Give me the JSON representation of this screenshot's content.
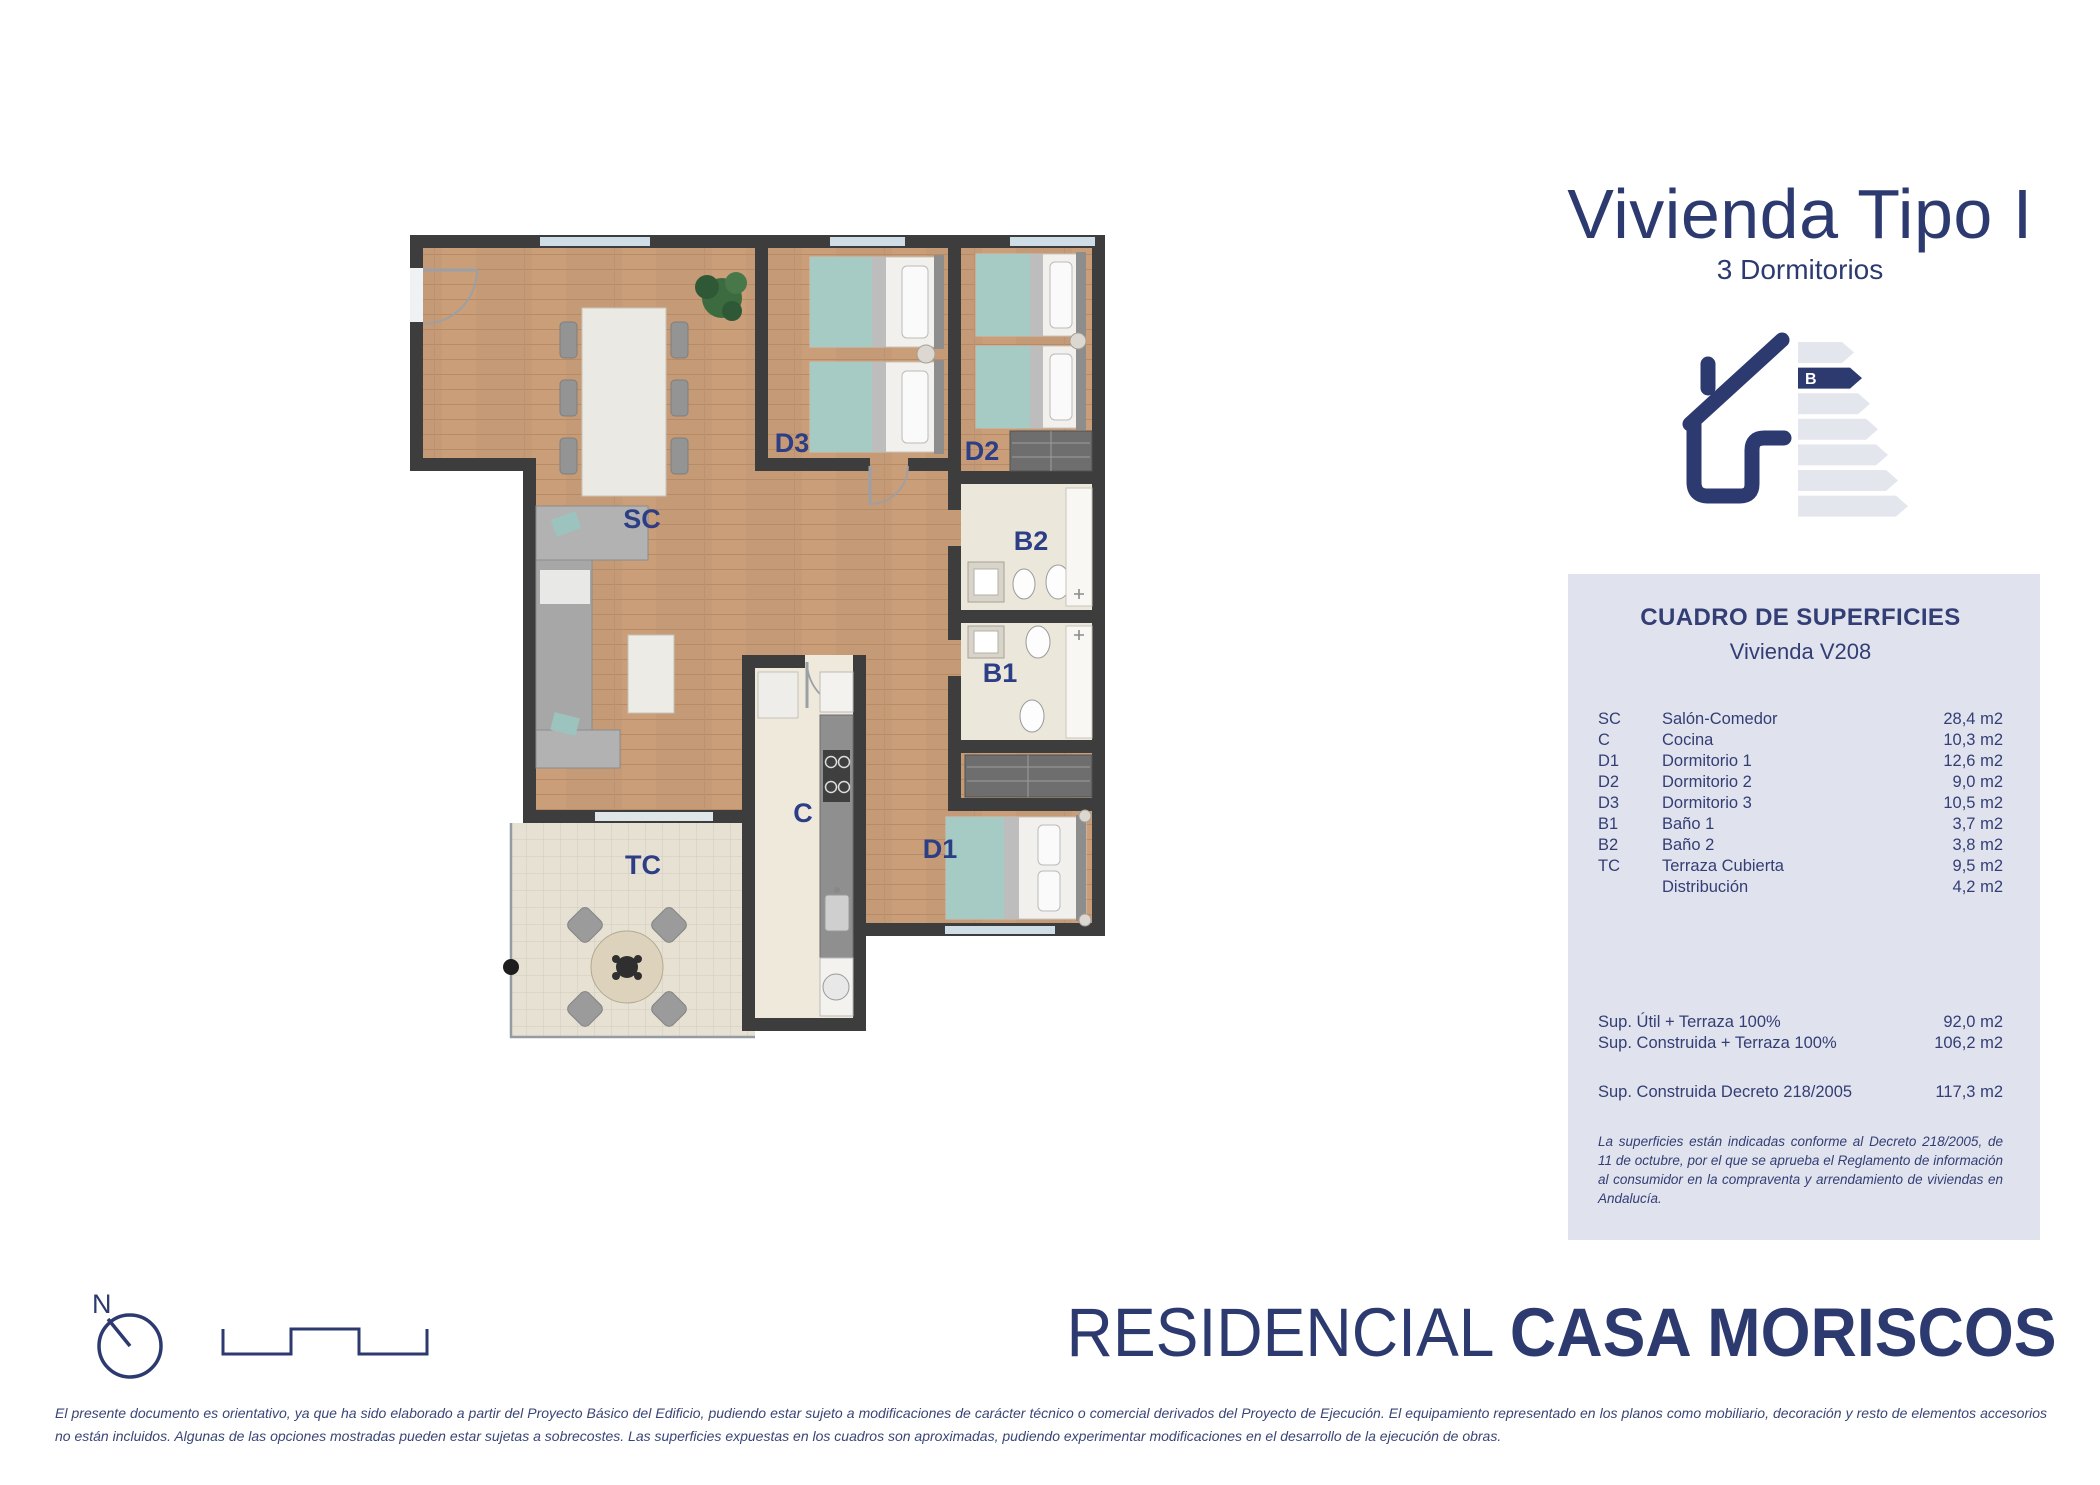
{
  "title": {
    "main": "Vivienda Tipo I",
    "subtitle": "3 Dormitorios"
  },
  "energy": {
    "rating": "B"
  },
  "surfaces": {
    "title": "CUADRO DE SUPERFICIES",
    "subtitle": "Vivienda V208",
    "rows": [
      {
        "code": "SC",
        "name": "Salón-Comedor",
        "value": "28,4 m2"
      },
      {
        "code": "C",
        "name": "Cocina",
        "value": "10,3 m2"
      },
      {
        "code": "D1",
        "name": "Dormitorio 1",
        "value": "12,6 m2"
      },
      {
        "code": "D2",
        "name": "Dormitorio 2",
        "value": "9,0 m2"
      },
      {
        "code": "D3",
        "name": "Dormitorio 3",
        "value": "10,5 m2"
      },
      {
        "code": "B1",
        "name": "Baño 1",
        "value": "3,7 m2"
      },
      {
        "code": "B2",
        "name": "Baño 2",
        "value": "3,8 m2"
      },
      {
        "code": "TC",
        "name": "Terraza Cubierta",
        "value": "9,5 m2"
      },
      {
        "code": "",
        "name": "Distribución",
        "value": "4,2 m2"
      }
    ],
    "totals": [
      {
        "name": "Sup. Útil + Terraza 100%",
        "value": "92,0 m2"
      },
      {
        "name": "Sup. Construida + Terraza 100%",
        "value": "106,2 m2"
      }
    ],
    "decree": {
      "name": "Sup. Construida Decreto 218/2005",
      "value": "117,3 m2"
    },
    "note": "La superficies están indicadas conforme al Decreto 218/2005, de 11 de octubre, por el que se aprueba el Reglamento de información al consumidor en la compraventa y arrendamiento de viviendas en Andalucía."
  },
  "plan": {
    "labels": {
      "sc": "SC",
      "d3": "D3",
      "d2": "D2",
      "b2": "B2",
      "b1": "B1",
      "c": "C",
      "d1": "D1",
      "tc": "TC"
    }
  },
  "brand": {
    "prefix": "RESIDENCIAL ",
    "name": "CASA MORISCOS"
  },
  "compass": {
    "letter": "N"
  },
  "disclaimer": "El presente documento es orientativo, ya que ha sido elaborado a partir del Proyecto Básico del Edificio, pudiendo estar sujeto a modificaciones de carácter técnico o comercial derivados del Proyecto de Ejecución. El equipamiento representado en los planos como mobiliario, decoración y resto de elementos accesorios no están incluidos. Algunas de las opciones mostradas pueden estar sujetas a sobrecostes. Las superficies expuestas en los cuadros son aproximadas, pudiendo experimentar modificaciones en el desarrollo de la ejecución de obras.",
  "colors": {
    "navy": "#2c3a6f",
    "panel_bg": "#e0e3ee",
    "wall": "#3d3d3d",
    "wood": "#c59a76",
    "teal": "#a6cac4"
  }
}
